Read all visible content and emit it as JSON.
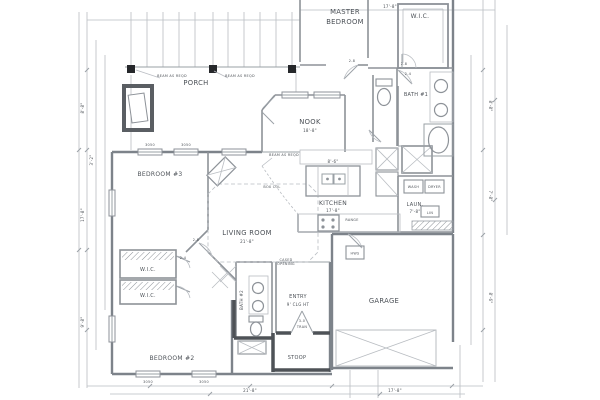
{
  "rooms": {
    "master_line1": "MASTER",
    "master_line2": "BEDROOM",
    "wic_master": "W.I.C.",
    "porch": "PORCH",
    "bath1": "BATH #1",
    "nook": "NOOK",
    "bedroom3": "BEDROOM #3",
    "living_room": "LIVING ROOM",
    "kitchen": "KITCHEN",
    "laundry": "LAUN.",
    "wic_a": "W.I.C.",
    "wic_b": "W.I.C.",
    "bath2": "BATH #2",
    "entry": "ENTRY",
    "garage": "GARAGE",
    "bedroom2": "BEDROOM #2",
    "stoop": "STOOP"
  },
  "fixtures": {
    "washer": "WASH",
    "dryer": "DRYER",
    "linen": "LIN",
    "water_heater": "HWS",
    "range": "RANGE"
  },
  "annotations": {
    "entry_ceiling": "9' CLG HT",
    "cased_1": "CASED",
    "cased_2": "OPENING",
    "beam_note": "BEAM AS REQD",
    "box_column": "BOX COL",
    "front_door_size": "3-0",
    "transom": "TRAN",
    "door_2_8": "2-8",
    "door_2_4": "2-4",
    "window_3050": "3050"
  },
  "dimensions": {
    "living_room": "21'-8\"",
    "nook": "18'-8\"",
    "kitchen": "17'-8\"",
    "island": "8'-6\"",
    "laundry": "7'-8\"",
    "d_8_8": "8'-8\"",
    "d_3_2": "3'-2\"",
    "d_9_8": "9'-8\"",
    "d_7_8": "7'-8\"",
    "d_8_6": "8'-6\"",
    "d_17_8": "17'-8\"",
    "d_21_8": "21'-8\""
  },
  "colors": {
    "background": "#ffffff",
    "line_light": "#b9bdc2",
    "line_medium": "#8d9298",
    "line_dark": "#4e5257",
    "column_black": "#26282b",
    "text": "#4c5157"
  }
}
